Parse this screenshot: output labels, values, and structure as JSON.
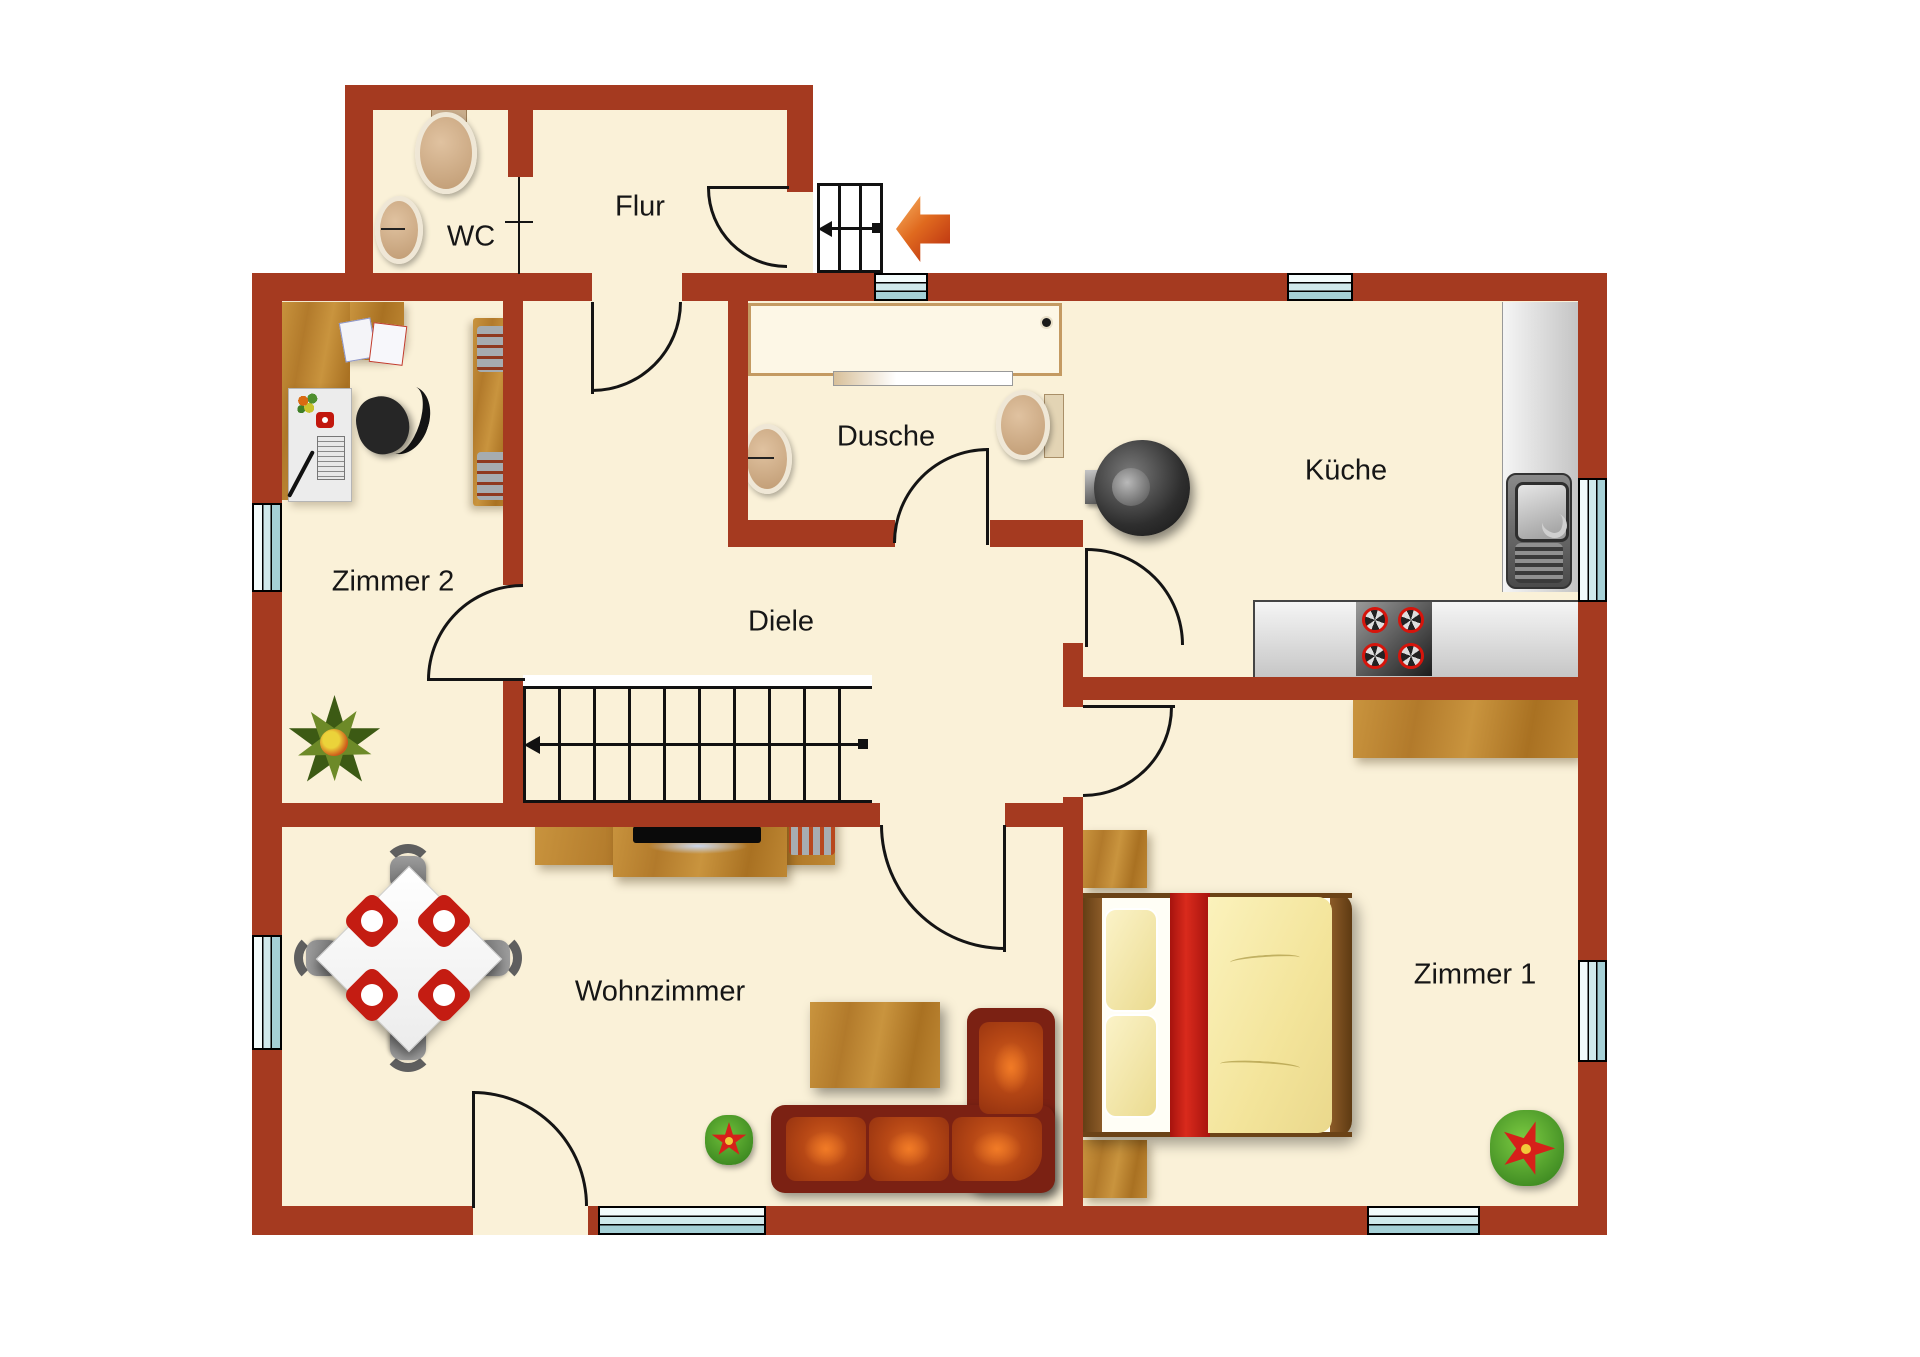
{
  "floorplan": {
    "rooms": [
      {
        "id": "wc",
        "label": "WC"
      },
      {
        "id": "flur",
        "label": "Flur"
      },
      {
        "id": "dusche",
        "label": "Dusche"
      },
      {
        "id": "kueche",
        "label": "Küche"
      },
      {
        "id": "zimmer2",
        "label": "Zimmer 2"
      },
      {
        "id": "diele",
        "label": "Diele"
      },
      {
        "id": "wohnzimmer",
        "label": "Wohnzimmer"
      },
      {
        "id": "zimmer1",
        "label": "Zimmer 1"
      }
    ],
    "colors": {
      "wall": "#A53A20",
      "floor": "#FAF1D8",
      "window_glass": "#BFE0E4",
      "wood": "#B97E2D",
      "sofa_leather": "#A8411A",
      "accent_red": "#C41C12",
      "counter_grey": "#D9D9D9"
    }
  }
}
